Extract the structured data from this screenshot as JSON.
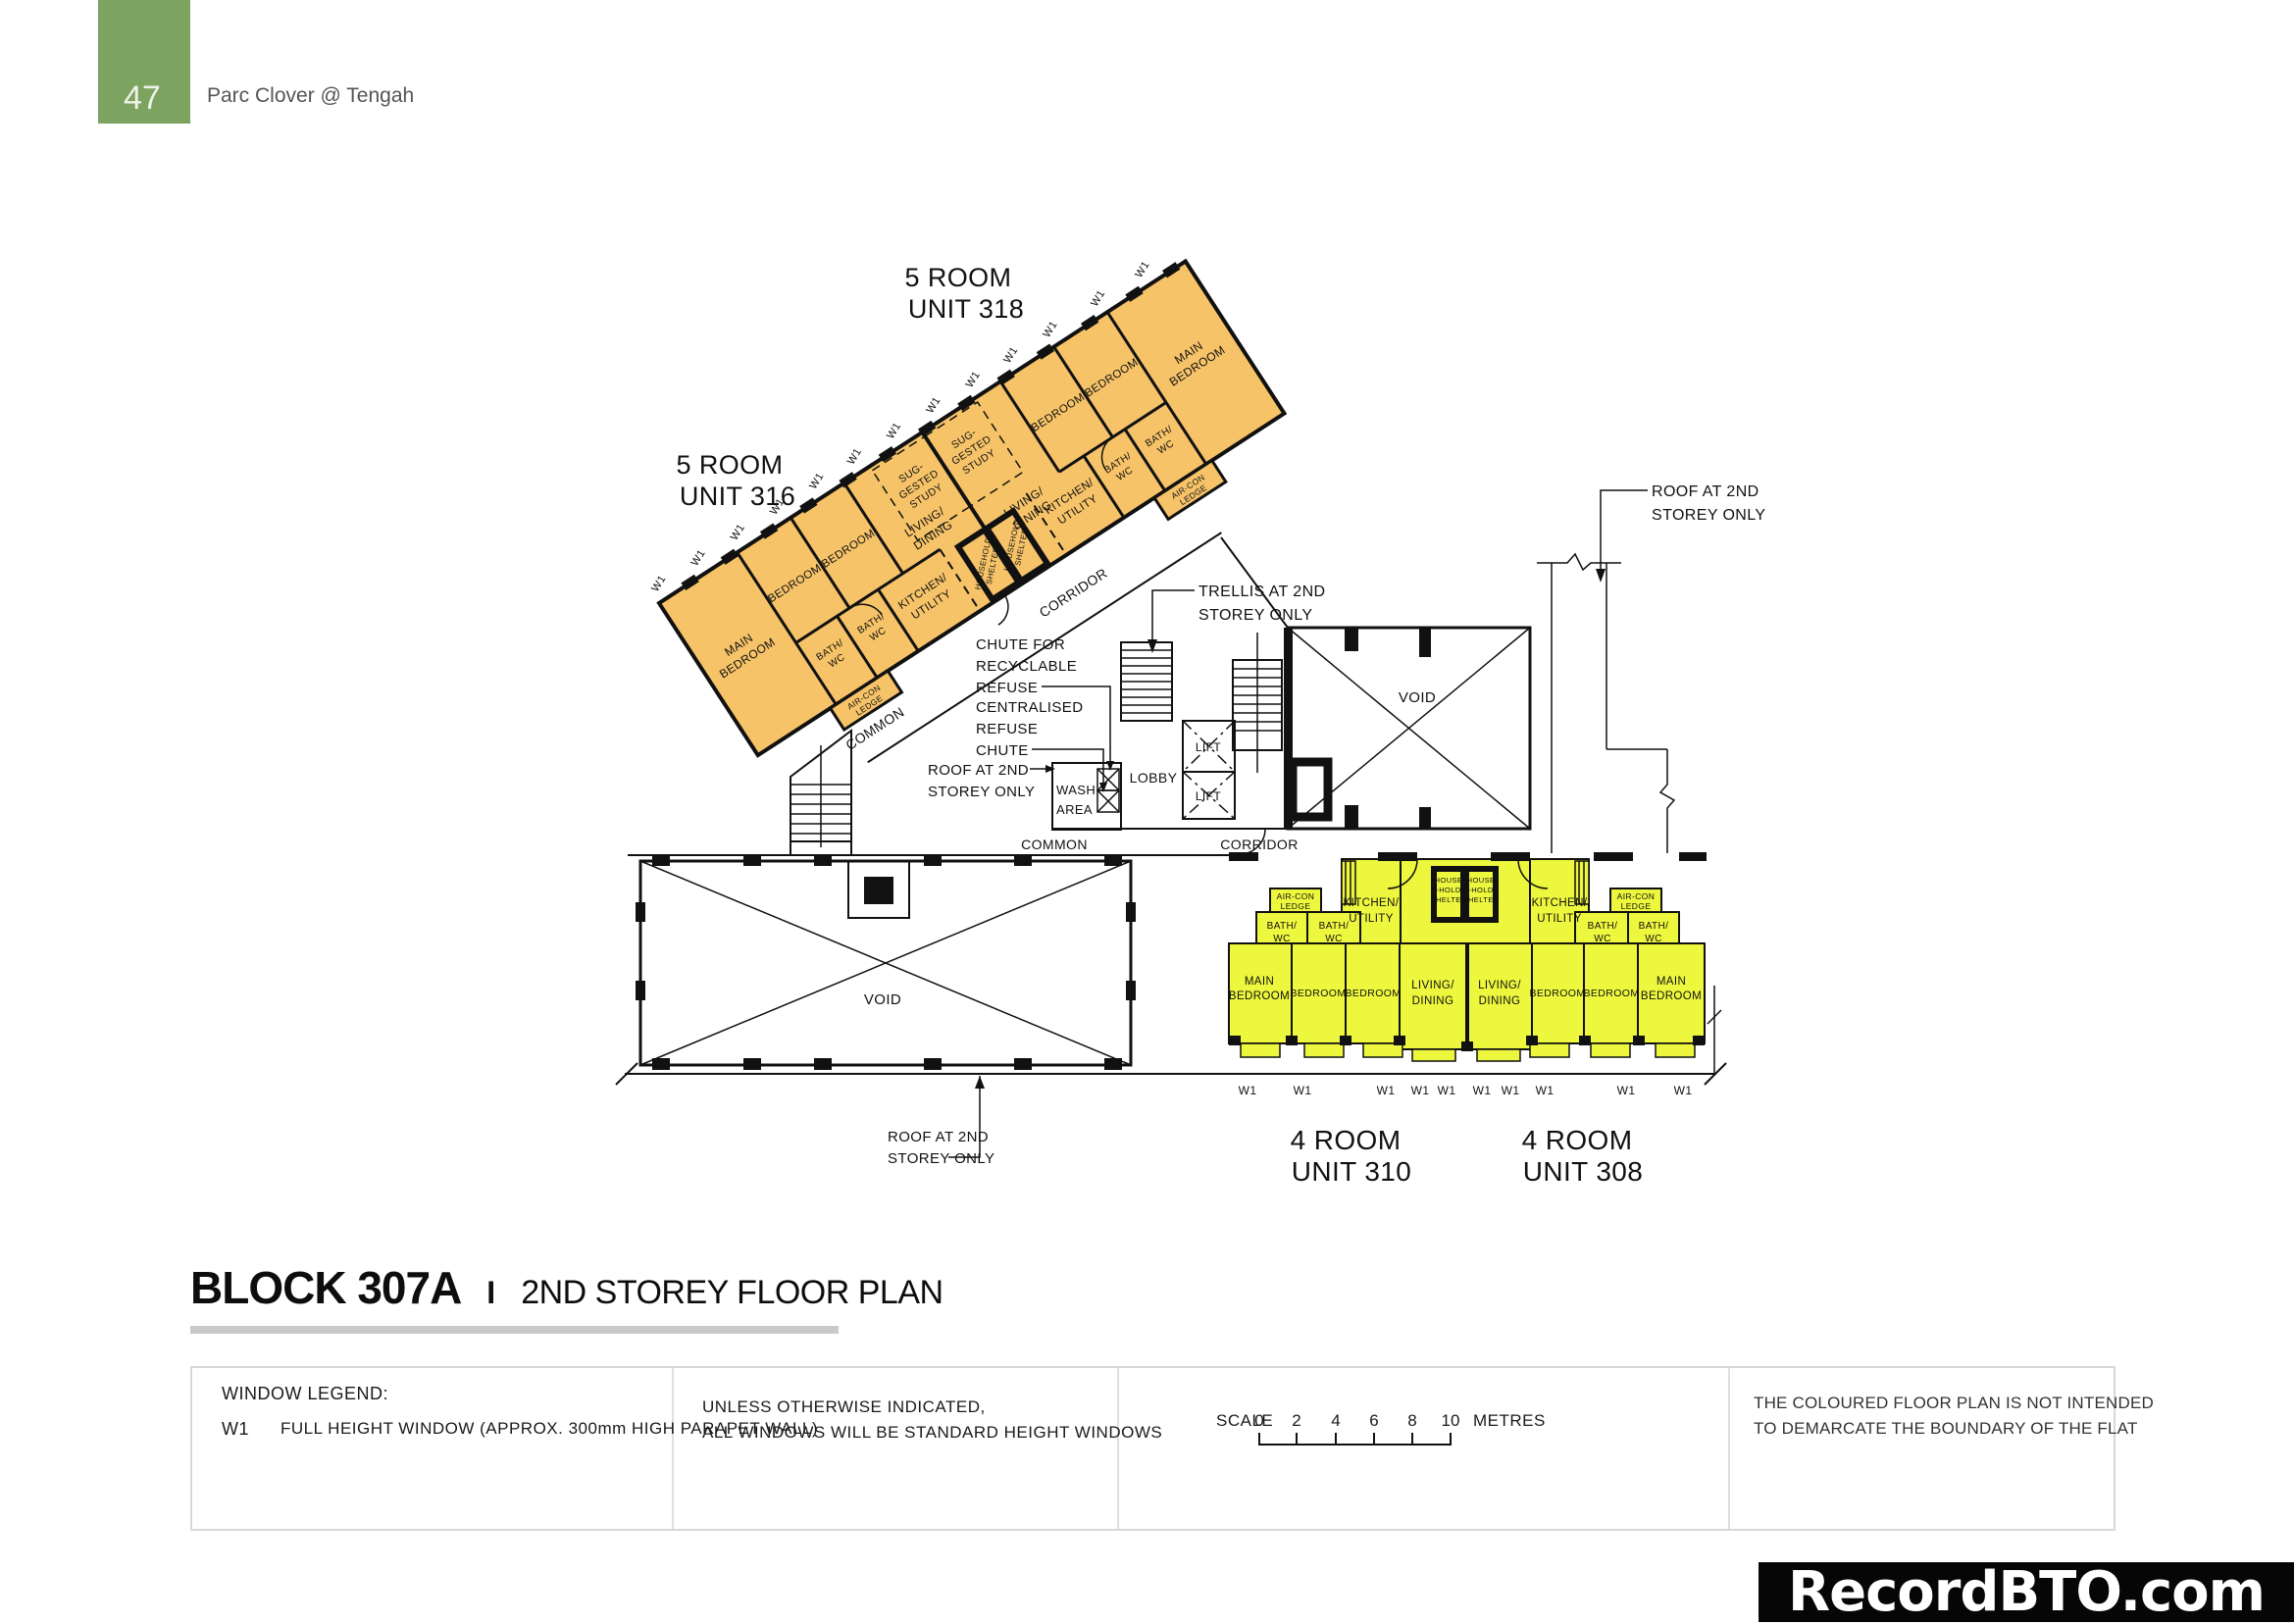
{
  "header": {
    "page_number": "47",
    "project_name": "Parc Clover @ Tengah"
  },
  "title_block": {
    "block": "BLOCK 307A",
    "separator": "I",
    "plan_name": "2ND STOREY FLOOR PLAN"
  },
  "units": {
    "u318_l1": "5 ROOM",
    "u318_l2": "UNIT 318",
    "u316_l1": "5 ROOM",
    "u316_l2": "UNIT 316",
    "u310_l1": "4 ROOM",
    "u310_l2": "UNIT 310",
    "u308_l1": "4 ROOM",
    "u308_l2": "UNIT 308"
  },
  "rooms": {
    "main_bedroom_l1": "MAIN",
    "main_bedroom_l2": "BEDROOM",
    "bedroom": "BEDROOM",
    "living_l1": "LIVING/",
    "living_l2": "DINING",
    "kitchen_l1": "KITCHEN/",
    "kitchen_l2": "UTILITY",
    "bath_l1": "BATH/",
    "bath_l2": "WC",
    "aircon_l1": "AIR-CON",
    "aircon_l2": "LEDGE",
    "study_l1": "SUG-",
    "study_l2": "GESTED",
    "study_l3": "STUDY",
    "household_shelter_l1": "HOUSEHOLD",
    "household_shelter_l2": "SHELTER",
    "house_shelter_l1": "HOUSE",
    "house_shelter_l2": "-HOLD",
    "house_shelter_l3": "SHELTER"
  },
  "areas": {
    "lobby": "LOBBY",
    "lift": "LIFT",
    "void": "VOID",
    "common": "COMMON",
    "corridor": "CORRIDOR",
    "wash_l1": "WASH",
    "wash_l2": "AREA"
  },
  "annotations": {
    "roof_l1": "ROOF AT 2ND",
    "roof_l2": "STOREY ONLY",
    "trellis_l1": "TRELLIS AT 2ND",
    "trellis_l2": "STOREY ONLY",
    "recyclable_l1": "CHUTE FOR",
    "recyclable_l2": "RECYCLABLE",
    "recyclable_l3": "REFUSE",
    "central_l1": "CENTRALISED",
    "central_l2": "REFUSE",
    "central_l3": "CHUTE",
    "window_tag": "W1"
  },
  "legend": {
    "window_legend_title": "WINDOW LEGEND:",
    "w1_code": "W1",
    "w1_desc": "FULL HEIGHT WINDOW (APPROX. 300mm HIGH PARAPET WALL)",
    "note_l1": "UNLESS OTHERWISE INDICATED,",
    "note_l2": "ALL WINDOWS WILL BE STANDARD HEIGHT WINDOWS",
    "scale_label": "SCALE",
    "scale_ticks": [
      "0",
      "2",
      "4",
      "6",
      "8",
      "10"
    ],
    "scale_unit": "METRES",
    "disclaimer_l1": "THE COLOURED FLOOR PLAN IS NOT INTENDED",
    "disclaimer_l2": "TO DEMARCATE THE BOUNDARY OF THE FLAT"
  },
  "watermark": "RecordBTO.com",
  "colors": {
    "accent_green": "#7da361",
    "unit5_fill": "#f6c368",
    "unit4_fill": "#edf73d",
    "line": "#111111"
  }
}
